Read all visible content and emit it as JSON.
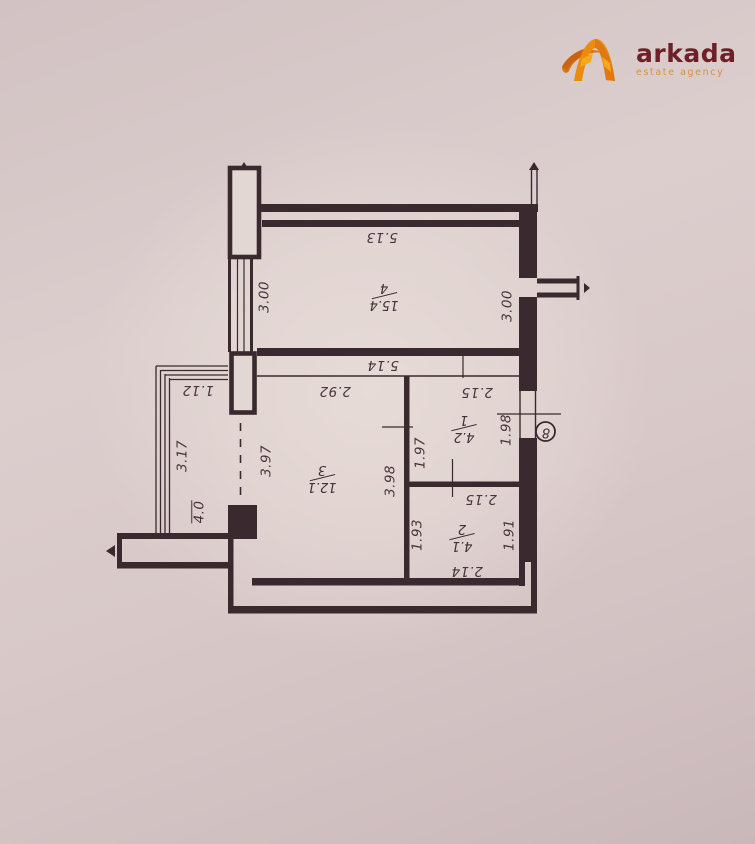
{
  "logo": {
    "brand": "arkada",
    "tagline": "estate agency",
    "brand_color": "#6e2029",
    "accent_color": "#e8860d"
  },
  "plan": {
    "wall_color": "#3a2a2f",
    "axis": {
      "marker": "8"
    },
    "rooms": {
      "r4": {
        "num": "4",
        "area": "15.4"
      },
      "r3": {
        "num": "3",
        "area": "12.1"
      },
      "r1": {
        "num": "1",
        "area": "4.2"
      },
      "r2": {
        "num": "2",
        "area": "4.1"
      }
    },
    "dims": {
      "room4_top": "5.13",
      "room4_bottom": "5.14",
      "room4_left": "3.00",
      "room4_right": "3.00",
      "room3_top": "2.92",
      "room3_left": "3.97",
      "room3_right": "3.98",
      "room1_top": "2.15",
      "room1_left": "1.97",
      "entry": "1.98",
      "room2_top": "2.15",
      "room2_left": "1.93",
      "room2_right": "1.91",
      "bottom": "2.14",
      "balcony_top": "1.12",
      "balcony_side": "3.17",
      "balcony_area": "4.0"
    }
  }
}
